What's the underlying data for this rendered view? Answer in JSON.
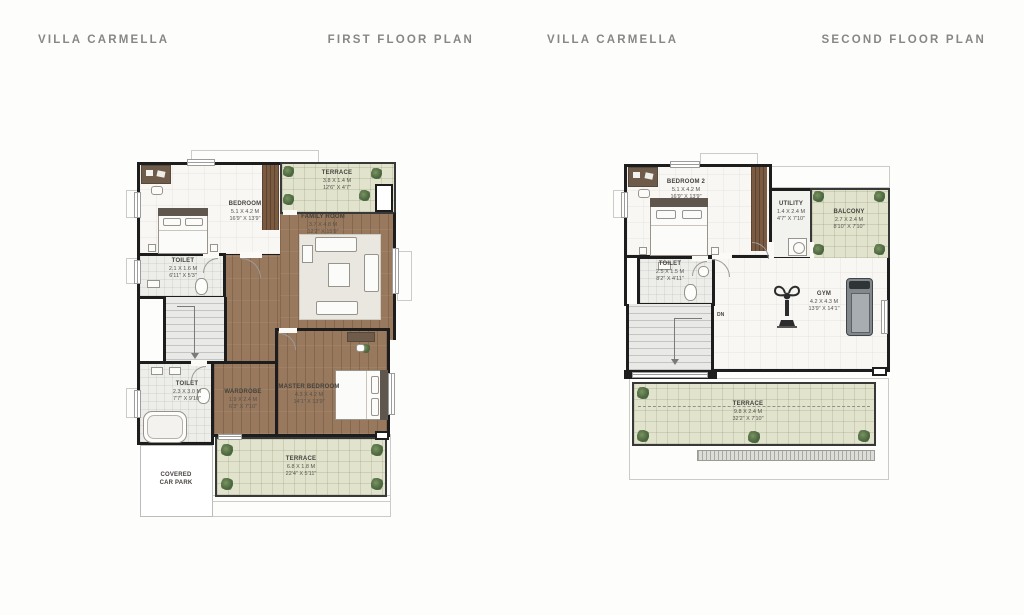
{
  "headers": [
    {
      "title": "VILLA CARMELLA",
      "subtitle": "FIRST FLOOR PLAN"
    },
    {
      "title": "VILLA CARMELLA",
      "subtitle": "SECOND FLOOR PLAN"
    }
  ],
  "colors": {
    "wall": "#1d1d1d",
    "wood_floor": "#98795d",
    "terrace_green": "#e1e3cc",
    "plant_green": "#4e6a41",
    "title_gray": "#878787"
  },
  "first_floor": {
    "bedroom": {
      "name": "BEDROOM",
      "m": "5.1 X 4.2 M",
      "ft": "16'9\" X 13'9\""
    },
    "terrace_top": {
      "name": "TERRACE",
      "m": "3.8 X 1.4 M",
      "ft": "12'6\" X 4'7\""
    },
    "family_room": {
      "name": "FAMILY ROOM",
      "m": "3.7 X 4.8 M",
      "ft": "12'2\" X 15'9\""
    },
    "toilet_upper": {
      "name": "TOILET",
      "m": "2.1 X 1.6 M",
      "ft": "6'11\" X 5'3\""
    },
    "toilet_lower": {
      "name": "TOILET",
      "m": "2.3 X 3.0 M",
      "ft": "7'7\" X 9'10\""
    },
    "wardrobe": {
      "name": "WARDROBE",
      "m": "1.9 X 2.4 M",
      "ft": "6'3\" X 7'10\""
    },
    "master_bedroom": {
      "name": "MASTER BEDROOM",
      "m": "4.3 X 4.2 M",
      "ft": "14'1\" X 13'9\""
    },
    "terrace_bottom": {
      "name": "TERRACE",
      "m": "6.8 X 1.8 M",
      "ft": "22'4\" X 5'11\""
    },
    "car_park": {
      "line1": "COVERED",
      "line2": "CAR PARK"
    }
  },
  "second_floor": {
    "bedroom2": {
      "name": "BEDROOM 2",
      "m": "5.1 X 4.2 M",
      "ft": "16'9\" X 13'9\""
    },
    "utility": {
      "name": "UTILITY",
      "m": "1.4 X 2.4 M",
      "ft": "4'7\" X 7'10\""
    },
    "balcony": {
      "name": "BALCONY",
      "m": "2.7 X 2.4 M",
      "ft": "8'10\" X 7'10\""
    },
    "toilet": {
      "name": "TOILET",
      "m": "2.5 X 1.5 M",
      "ft": "8'2\" X 4'11\""
    },
    "gym": {
      "name": "GYM",
      "m": "4.2 X 4.3 M",
      "ft": "13'9\" X 14'1\""
    },
    "terrace": {
      "name": "TERRACE",
      "m": "9.8 X 2.4 M",
      "ft": "32'2\" X 7'10\""
    },
    "stairs_label": "DN"
  }
}
